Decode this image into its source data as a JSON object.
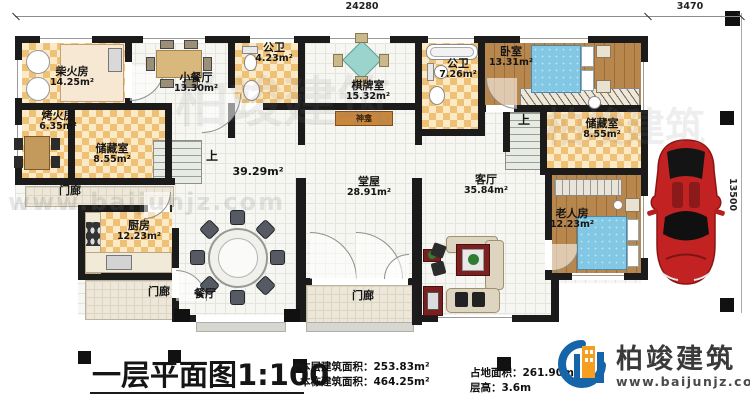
{
  "dims": {
    "top": "24280",
    "top_right": "3470",
    "side": "13500"
  },
  "labels": {
    "up": "上"
  },
  "rooms": {
    "chai": {
      "name": "柴火房",
      "area": "14.25m²"
    },
    "xiaocanting": {
      "name": "小餐厅",
      "area": "13.30m²"
    },
    "gongwei1": {
      "name": "公卫",
      "area": "4.23m²"
    },
    "qipai": {
      "name": "棋牌室",
      "area": "15.32m²"
    },
    "gongwei2": {
      "name": "公卫",
      "area": "7.26m²"
    },
    "woshi": {
      "name": "卧室",
      "area": "13.31m²"
    },
    "kaohuo": {
      "name": "烤火房",
      "area": "6.35m²"
    },
    "chucang1": {
      "name": "储藏室",
      "area": "8.55m²"
    },
    "chucang2": {
      "name": "储藏室",
      "area": "8.55m²"
    },
    "chufang": {
      "name": "厨房",
      "area": "12.23m²"
    },
    "tangwu": {
      "name": "堂屋",
      "area": "28.91m²"
    },
    "keting": {
      "name": "客厅",
      "area": "35.84m²"
    },
    "laoren": {
      "name": "老人房",
      "area": "12.23m²"
    },
    "canting": {
      "name": "餐厅"
    },
    "menlang1": {
      "name": "门廊"
    },
    "menlang2": {
      "name": "门廊"
    },
    "menlang3": {
      "name": "门廊"
    },
    "shenkan": {
      "name": "神龛"
    },
    "open_area": {
      "area": "39.29m²"
    }
  },
  "footer": {
    "title": "一层平面图1:100",
    "stats_left": [
      "本层建筑面积：253.83m²",
      "本栋建筑面积：464.25m²"
    ],
    "stats_right": [
      "占地面积：261.90m²",
      "层高：3.6m"
    ]
  },
  "brand": {
    "name": "柏竣建筑",
    "url": "www.baijunjz.com"
  },
  "watermark": {
    "text": "柏竣建筑",
    "url": "www.baijunjz.com"
  },
  "colors": {
    "accent_blue": "#1565a8",
    "accent_orange": "#f59e1f",
    "car_red": "#c32222",
    "wall": "#1b1b1b"
  }
}
